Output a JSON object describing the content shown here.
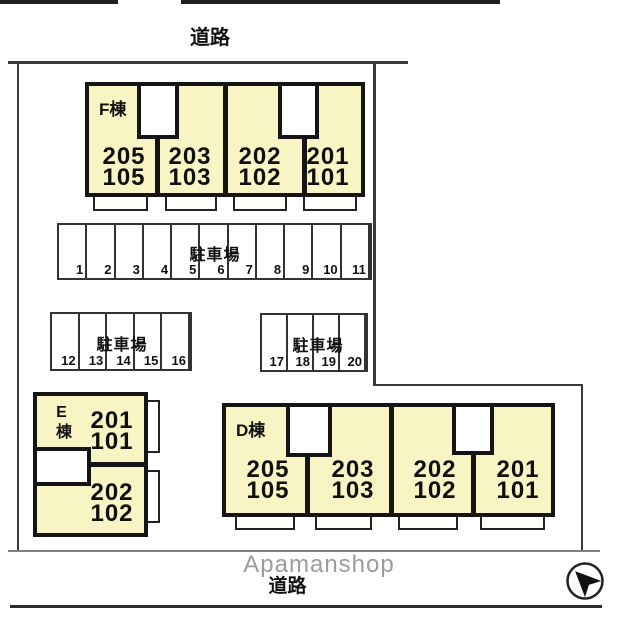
{
  "roads": {
    "top_label": "道路",
    "bottom_label": "道路"
  },
  "watermark": {
    "text": "Apamanshop"
  },
  "colors": {
    "building_fill": "#F9F4C3",
    "outline": "#151515",
    "boundary": "#3a3a3a",
    "watermark": "#9c9c9c"
  },
  "buildings": {
    "f": {
      "label": "F棟",
      "units": [
        {
          "upper": "205",
          "lower": "105"
        },
        {
          "upper": "203",
          "lower": "103"
        },
        {
          "upper": "202",
          "lower": "102"
        },
        {
          "upper": "201",
          "lower": "101"
        }
      ]
    },
    "e": {
      "label": "E棟",
      "units": [
        {
          "upper": "201",
          "lower": "101"
        },
        {
          "upper": "202",
          "lower": "102"
        }
      ]
    },
    "d": {
      "label": "D棟",
      "units": [
        {
          "upper": "205",
          "lower": "105"
        },
        {
          "upper": "203",
          "lower": "103"
        },
        {
          "upper": "202",
          "lower": "102"
        },
        {
          "upper": "201",
          "lower": "101"
        }
      ]
    }
  },
  "parking_lots": [
    {
      "label": "駐車場",
      "spaces": [
        "1",
        "2",
        "3",
        "4",
        "5",
        "6",
        "7",
        "8",
        "9",
        "10",
        "11"
      ]
    },
    {
      "label": "駐車場",
      "spaces": [
        "12",
        "13",
        "14",
        "15",
        "16"
      ]
    },
    {
      "label": "駐車場",
      "spaces": [
        "17",
        "18",
        "19",
        "20"
      ]
    }
  ],
  "compass": {
    "name": "north-arrow"
  }
}
